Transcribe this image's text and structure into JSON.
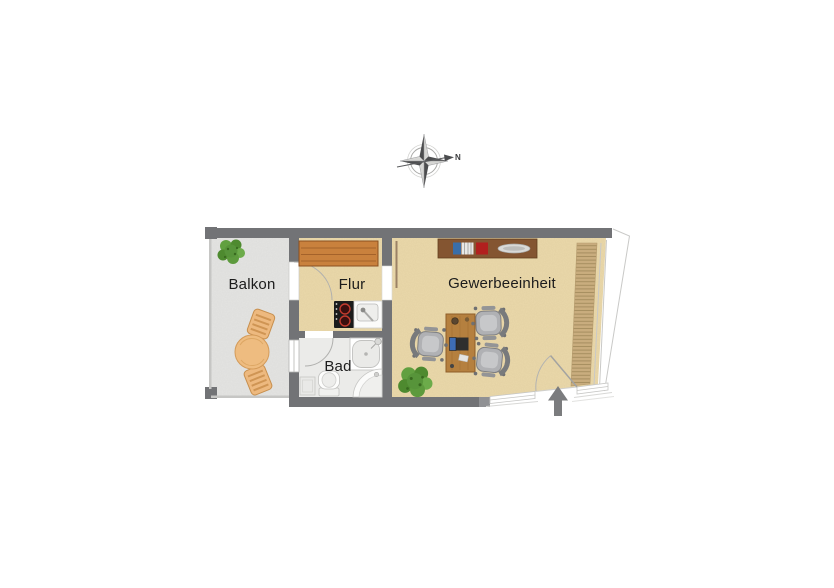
{
  "compass": {
    "north_label": "N"
  },
  "plan": {
    "rooms": {
      "balkon": {
        "label": "Balkon"
      },
      "flur": {
        "label": "Flur"
      },
      "bad": {
        "label": "Bad"
      },
      "gewerbe": {
        "label": "Gewerbeeinheit"
      }
    },
    "colors": {
      "wall": "#727376",
      "wall_endcap": "#909194",
      "floor_main": "#ebd9ab",
      "floor_balcony": "#e4e4e2",
      "floor_bath": "#ebebe9",
      "wardrobe_wood": "#c9813d",
      "desk_wood": "#b5803f",
      "sideboard_wood": "#845531",
      "lamella": "#c9ad7e",
      "plant_green": "#57943a",
      "balcony_furniture": "#edb97f",
      "arrow": "#7b7c7e"
    },
    "icons": [
      "compass-icon",
      "plant-icon",
      "bistro-table-icon",
      "balcony-chair-icon",
      "wardrobe-icon",
      "cooktop-icon",
      "kitchen-sink-icon",
      "shower-icon",
      "toilet-icon",
      "washbasin-icon",
      "bath-cabinet-icon",
      "sideboard-icon",
      "desk-icon",
      "laptop-icon",
      "office-chair-icon",
      "floor-plant-icon",
      "entrance-arrow-icon",
      "lamella-blind-icon"
    ]
  }
}
